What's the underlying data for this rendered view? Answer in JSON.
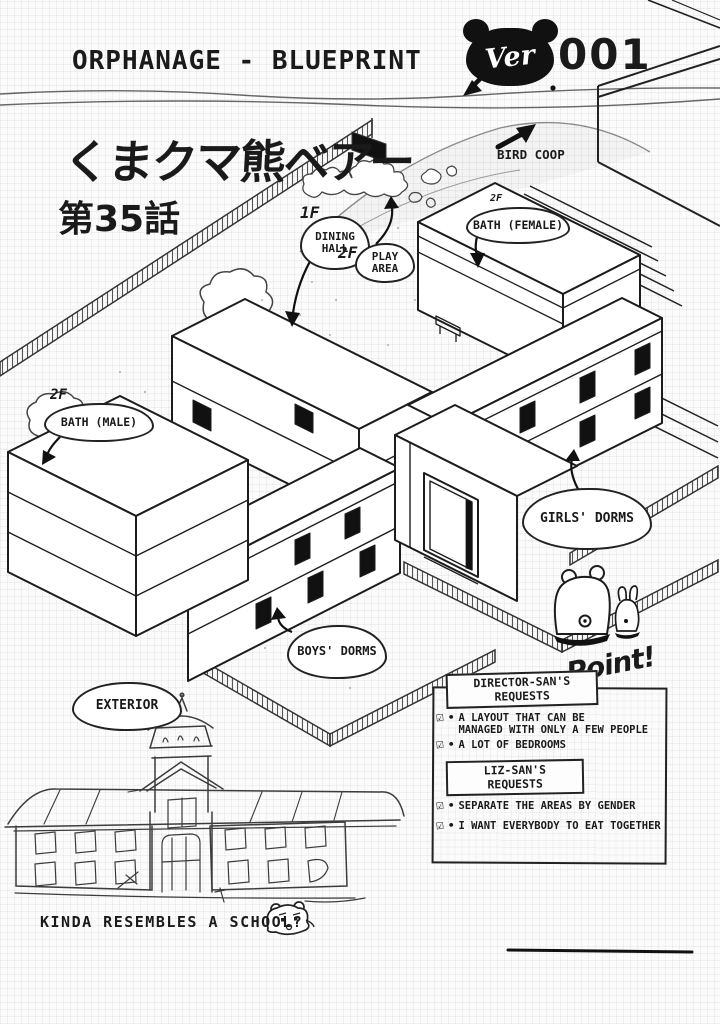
{
  "page": {
    "header": {
      "title": "ORPHANAGE - BLUEPRINT",
      "version_badge": {
        "prefix": "Ver",
        "number": "001"
      }
    },
    "series": {
      "title_jp": "くまクマ熊ベアー",
      "episode_jp": "第35話"
    },
    "blueprint_labels": {
      "bird_coop": "BIRD COOP",
      "dining": {
        "floor": "1F",
        "line1": "DINING",
        "line2": "HALL"
      },
      "play": {
        "floor": "2F",
        "line1": "PLAY",
        "line2": "AREA"
      },
      "bath_female": {
        "floor": "2F",
        "label": "BATH (FEMALE)"
      },
      "bath_male": {
        "floor": "2F",
        "label": "BATH (MALE)"
      },
      "girls_dorms": "GIRLS' DORMS",
      "boys_dorms": "BOYS' DORMS",
      "exterior": "EXTERIOR"
    },
    "notes_panel": {
      "point_label": "Point!",
      "sections": [
        {
          "heading_line1": "DIRECTOR-SAN'S",
          "heading_line2": "REQUESTS",
          "items": [
            {
              "lines": [
                "A LAYOUT THAT CAN BE",
                "MANAGED WITH ONLY A FEW PEOPLE"
              ]
            },
            {
              "lines": [
                "A LOT OF BEDROOMS"
              ]
            }
          ]
        },
        {
          "heading_line1": "LIZ-SAN'S",
          "heading_line2": "REQUESTS",
          "items": [
            {
              "lines": [
                "SEPARATE THE AREAS BY GENDER"
              ]
            },
            {
              "lines": [
                "I WANT EVERYBODY TO EAT TOGETHER"
              ]
            }
          ]
        }
      ]
    },
    "caption": "KINDA RESEMBLES A SCHOOL?",
    "icons": {
      "checkbox": "☑",
      "bullet": "•"
    },
    "colors": {
      "ink": "#1a1a1a",
      "paper": "#fbfbfb",
      "badge": "#111111"
    }
  }
}
